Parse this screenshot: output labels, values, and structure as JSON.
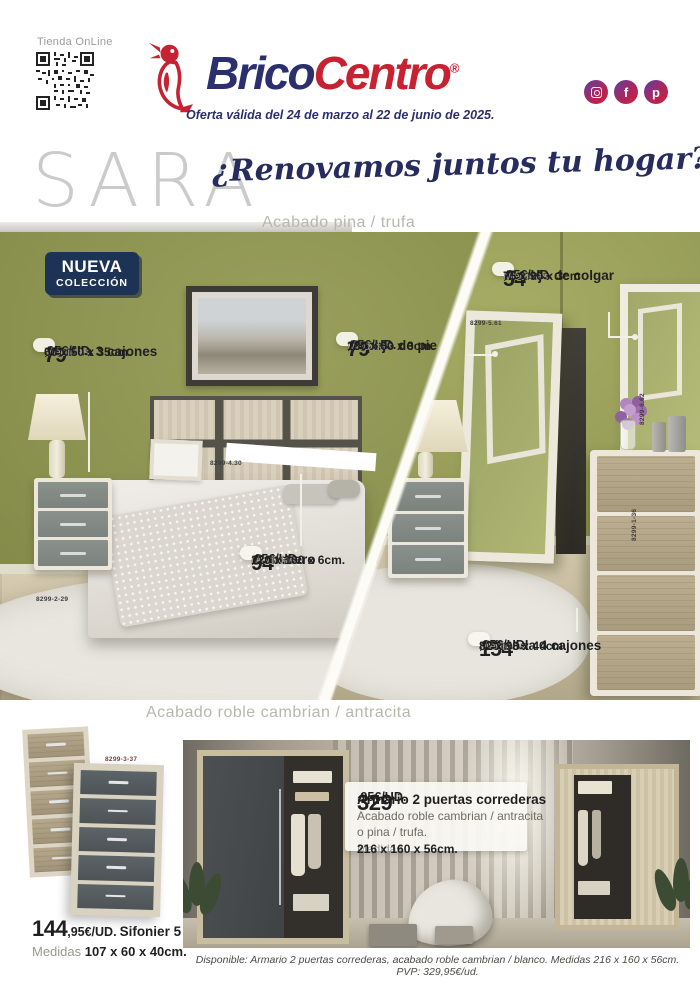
{
  "header": {
    "store_label": "Tienda OnLine",
    "logo_brico": "Brico",
    "logo_centro": "Centro",
    "logo_reg": "®",
    "offer": "Oferta válida del 24 de marzo al 22 de junio de 2025.",
    "social": {
      "facebook_glyph": "f",
      "pinterest_glyph": "p"
    }
  },
  "hero": {
    "collection": "SARA",
    "tagline": "¿Renovamos juntos tu hogar?",
    "finish_top": "Acabado pina / trufa",
    "badge_line1": "NUEVA",
    "badge_line2": "COLECCIÓN"
  },
  "callouts": {
    "mesilla": {
      "price": "79",
      "suffix": ",95€/UD.",
      "name": "Mesilla 3 cajones",
      "medidas": "Medidas",
      "dims": "60 x 50 x 35cm."
    },
    "espejo_colgar": {
      "price": "54",
      "suffix": ",95€/UD.",
      "name": "Espejo de colgar",
      "medidas": "Medidas",
      "dims": "75 x 90 x 3cm"
    },
    "espejo_pie": {
      "price": "79",
      "suffix": ",95€/UD.",
      "name": "Espejo de pie",
      "medidas": "Medidas",
      "dims": "180 x 60 x 3cm."
    },
    "cabecero": {
      "price": "94",
      "suffix": ",95€/UD.",
      "name": "Cabecero",
      "medidas": "Medidas",
      "dims": "120 x 160 x 6cm."
    },
    "comoda": {
      "price": "154",
      "suffix": ",95€/UD.",
      "name": "Cómoda 4 cajones",
      "medidas": "Medidas",
      "dims": "82 x 98 x 40cm."
    }
  },
  "refs": {
    "headboard": "8299-4.30",
    "rug": "8299-2-29",
    "mirror_stand": "8299-5.61",
    "mirror_wall": "8299-6.62",
    "comoda": "8299-1-36",
    "sifonier": "8299-3-37"
  },
  "section2": {
    "title": "Acabado roble cambrian / antracita",
    "sifonier": {
      "price": "144",
      "suffix": ",95€/UD.",
      "name": "Sifonier 5 cajones",
      "medidas": "Medidas",
      "dims": "107 x 60 x 40cm."
    },
    "armario": {
      "price": "329",
      "suffix": ",95€/UD.",
      "name": "Armario 2 puertas correderas",
      "finish1": "Acabado roble cambrian / antracita",
      "finish2": "o pina / trufa.",
      "medidas": "Medidas",
      "dims": "216 x 160 x 56cm."
    },
    "footnote": "Disponible: Armario 2 puertas correderas, acabado roble cambrian / blanco. Medidas 216 x 160 x 56cm. PVP: 329,95€/ud."
  },
  "colors": {
    "brand_navy": "#2b2f6e",
    "brand_red": "#c62232",
    "badge_navy": "#1d3356",
    "wall_green": "#8e9150"
  }
}
